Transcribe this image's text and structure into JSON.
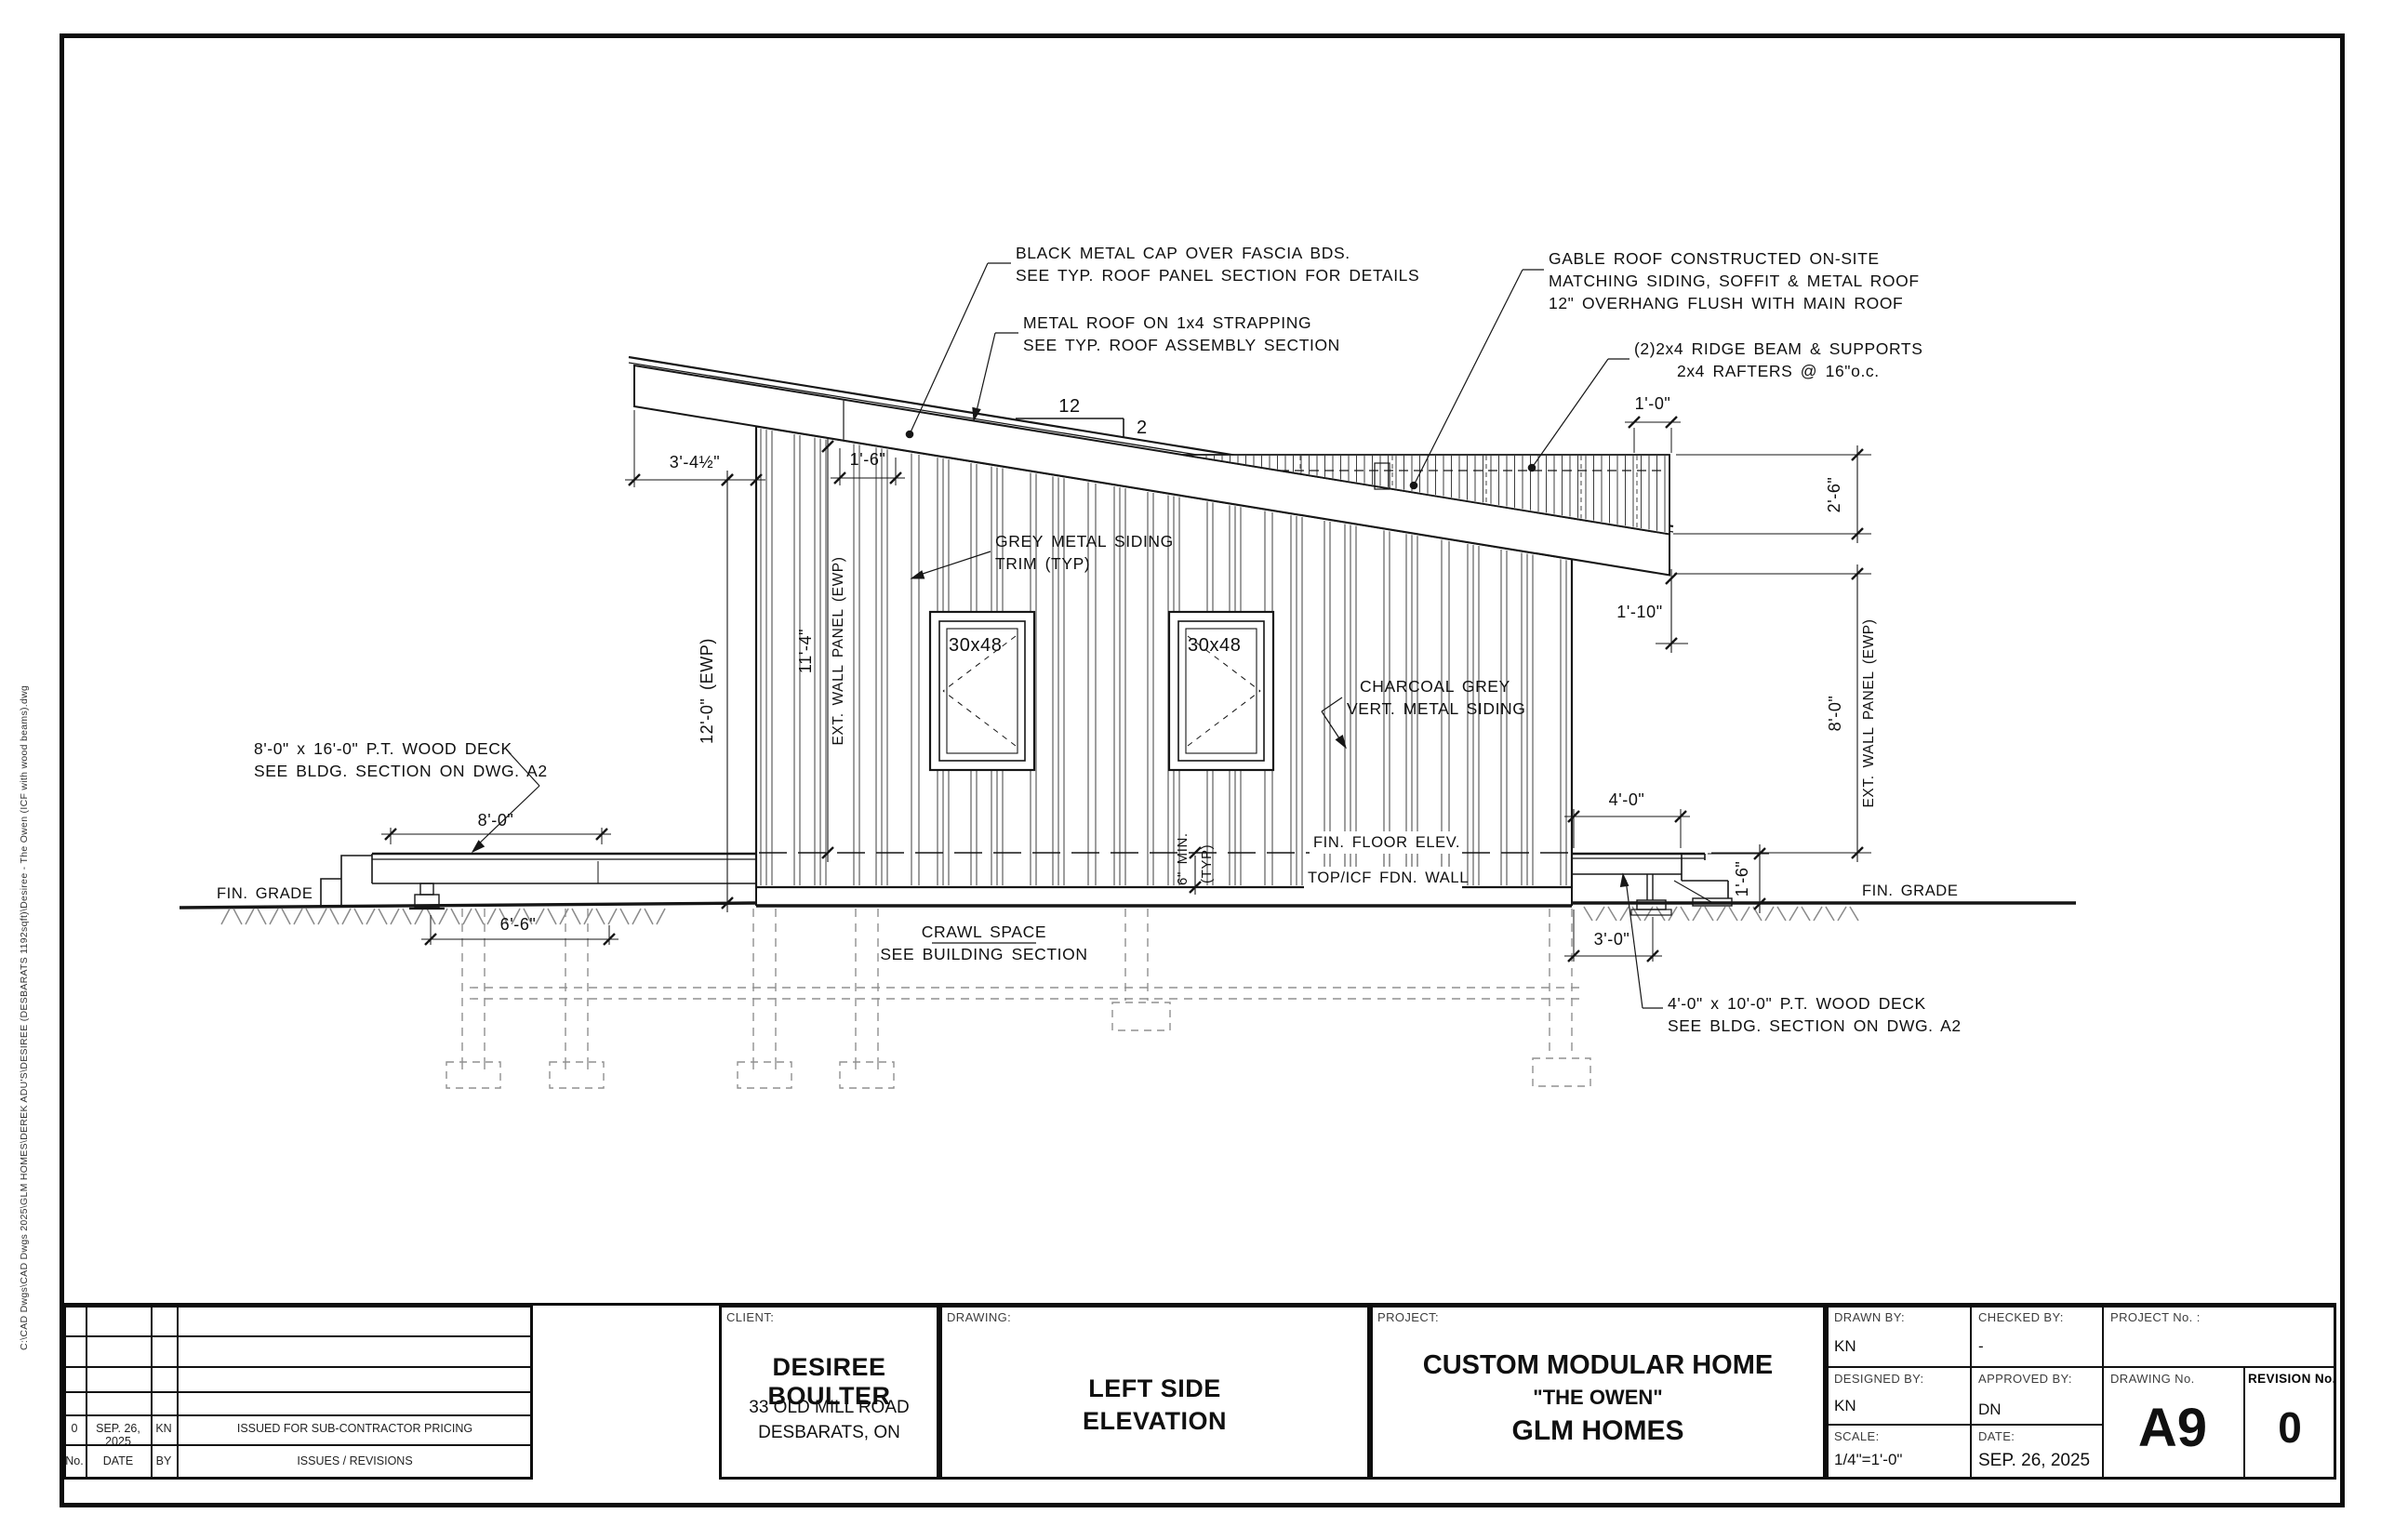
{
  "meta": {
    "file_path": "C:\\CAD Dwgs\\CAD Dwgs 2025\\GLM HOMES\\DEREK ADU'S\\DESIREE (DESBARATS 1192sqft)\\Desiree - The Owen (ICF with wood beams).dwg"
  },
  "drawing_notes": {
    "note_black_cap_1": "BLACK METAL CAP OVER FASCIA BDS.",
    "note_black_cap_2": "SEE TYP. ROOF PANEL SECTION FOR DETAILS",
    "note_metal_roof_1": "METAL ROOF ON 1x4 STRAPPING",
    "note_metal_roof_2": "SEE TYP. ROOF ASSEMBLY SECTION",
    "note_gable_1": "GABLE ROOF CONSTRUCTED ON-SITE",
    "note_gable_2": "MATCHING SIDING, SOFFIT & METAL ROOF",
    "note_gable_3": "12\" OVERHANG FLUSH WITH MAIN ROOF",
    "note_ridge_1": "(2)2x4 RIDGE BEAM & SUPPORTS",
    "note_ridge_2": "2x4 RAFTERS @ 16\"o.c.",
    "note_trim_1": "GREY METAL SIDING",
    "note_trim_2": "TRIM (TYP)",
    "note_siding_1": "CHARCOAL GREY",
    "note_siding_2": "VERT. METAL SIDING",
    "note_deck_left_1": "8'-0\" x 16'-0\" P.T. WOOD DECK",
    "note_deck_left_2": "SEE BLDG. SECTION ON DWG. A2",
    "note_deck_right_1": "4'-0\" x 10'-0\" P.T. WOOD DECK",
    "note_deck_right_2": "SEE BLDG. SECTION ON DWG. A2",
    "note_crawl_1": "CRAWL SPACE",
    "note_crawl_2": "SEE BUILDING SECTION",
    "fin_floor": "FIN. FLOOR ELEV.",
    "top_icf": "TOP/ICF FDN. WALL",
    "fin_grade_left": "FIN. GRADE",
    "fin_grade_right": "FIN. GRADE",
    "min_6": "6\" MIN.",
    "typ": "(TYP)",
    "slope_rise": "12",
    "slope_run": "2",
    "window_label_1": "30x48",
    "window_label_2": "30x48"
  },
  "dimensions": {
    "d_3_4_half": "3'-4½\"",
    "d_1_6_top": "1'-6\"",
    "d_12_0_ewp": "12'-0\" (EWP)",
    "d_11_4": "11'-4\"",
    "d_ewp_left": "EXT. WALL PANEL (EWP)",
    "d_1_0": "1'-0\"",
    "d_2_6": "2'-6\"",
    "d_1_10": "1'-10\"",
    "d_8_0_ewp": "8'-0\"",
    "d_ewp_right": "EXT. WALL PANEL (EWP)",
    "d_8_0_deck": "8'-0\"",
    "d_6_6": "6'-6\"",
    "d_4_0": "4'-0\"",
    "d_1_6_right": "1'-6\"",
    "d_3_0": "3'-0\""
  },
  "titleblock": {
    "revisions": {
      "header_no": "No.",
      "header_date": "DATE",
      "header_by": "BY",
      "header_desc": "ISSUES / REVISIONS",
      "entry_no": "0",
      "entry_date": "SEP. 26, 2025",
      "entry_by": "KN",
      "entry_desc": "ISSUED FOR SUB-CONTRACTOR PRICING"
    },
    "client": {
      "label": "CLIENT:",
      "name": "DESIREE BOULTER",
      "address1": "33 OLD MILL ROAD",
      "address2": "DESBARATS, ON"
    },
    "drawing": {
      "label": "DRAWING:",
      "title1": "LEFT SIDE",
      "title2": "ELEVATION"
    },
    "project": {
      "label": "PROJECT:",
      "line1": "CUSTOM MODULAR HOME",
      "line2": "\"THE OWEN\"",
      "line3": "GLM HOMES"
    },
    "info": {
      "drawn_by_label": "DRAWN BY:",
      "drawn_by": "KN",
      "checked_by_label": "CHECKED BY:",
      "checked_by": "-",
      "project_no_label": "PROJECT No. :",
      "designed_by_label": "DESIGNED BY:",
      "designed_by": "KN",
      "approved_by_label": "APPROVED BY:",
      "approved_by": "DN",
      "drawing_no_label": "DRAWING No.",
      "drawing_no": "A9",
      "revision_no_label": "REVISION No.",
      "revision_no": "0",
      "scale_label": "SCALE:",
      "scale": "1/4\"=1'-0\"",
      "date_label": "DATE:",
      "date": "SEP. 26, 2025"
    }
  },
  "colors": {
    "line": "#161616",
    "gray_dashed": "#909090",
    "hatch": "#8a8a8a"
  }
}
